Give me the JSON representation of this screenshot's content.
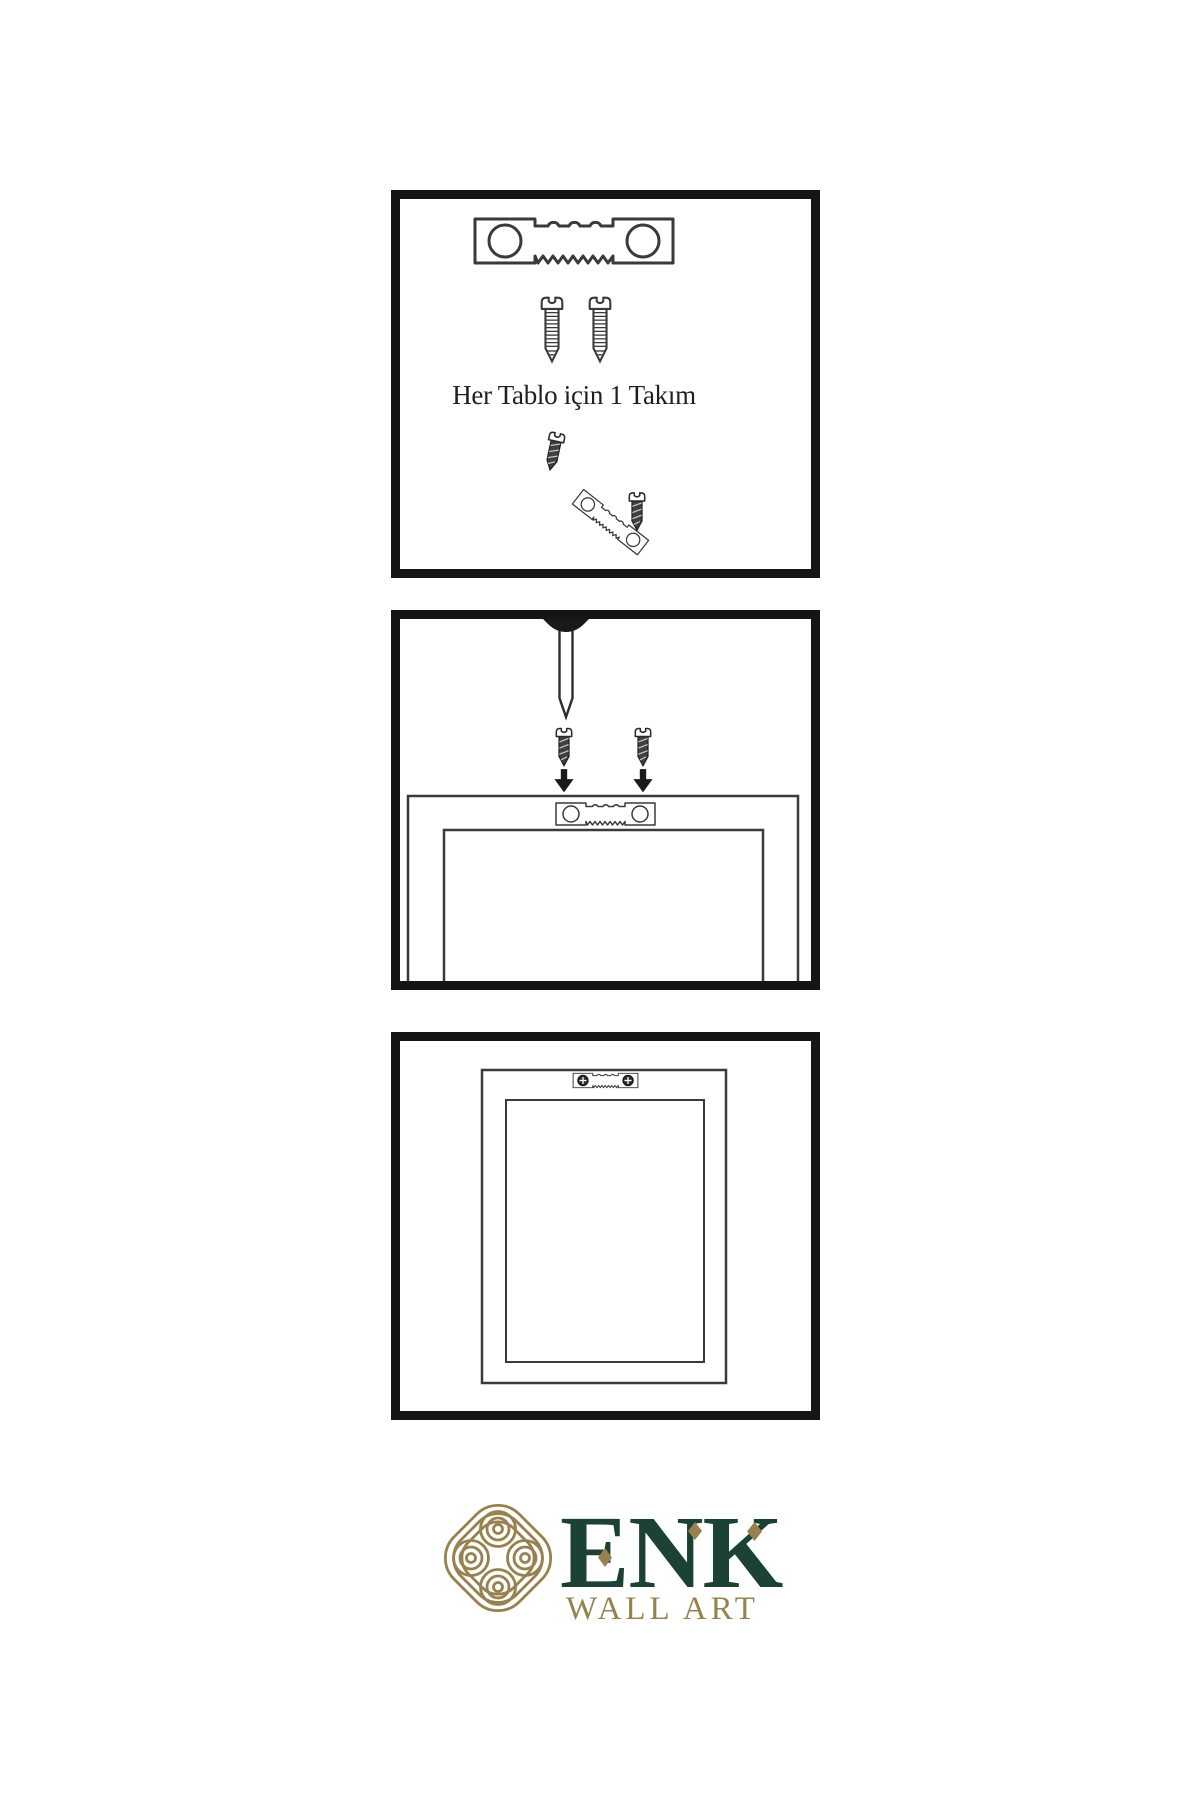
{
  "page": {
    "background": "#ffffff",
    "width": 1200,
    "height": 1800
  },
  "colors": {
    "ink": "#1a1a1a",
    "line_art": "#3a3a3a",
    "screw_shaft": "#404040",
    "brand_green": "#1b4234",
    "brand_gold": "#97814e"
  },
  "panels": [
    {
      "id": "hardware-kit",
      "caption": "Her Tablo için 1 Takım",
      "items": [
        "sawtooth-hanger-icon",
        "screw-icon",
        "screw-icon",
        "small-screw-icon",
        "tilted-sawtooth-hanger-icon",
        "small-screw-icon"
      ]
    },
    {
      "id": "mounting-step",
      "caption": "",
      "items": [
        "wall-nail-icon",
        "dark-screw-icon",
        "dark-screw-icon",
        "down-arrow-icon",
        "down-arrow-icon",
        "frame-back-icon",
        "sawtooth-hanger-icon"
      ]
    },
    {
      "id": "hanging-step",
      "caption": "",
      "items": [
        "frame-front-icon",
        "mounted-sawtooth-hanger-icon",
        "screw-head-icon",
        "screw-head-icon"
      ]
    }
  ],
  "brand": {
    "name": "ENK",
    "tagline": "WALL ART",
    "logo": "knot-icon"
  }
}
